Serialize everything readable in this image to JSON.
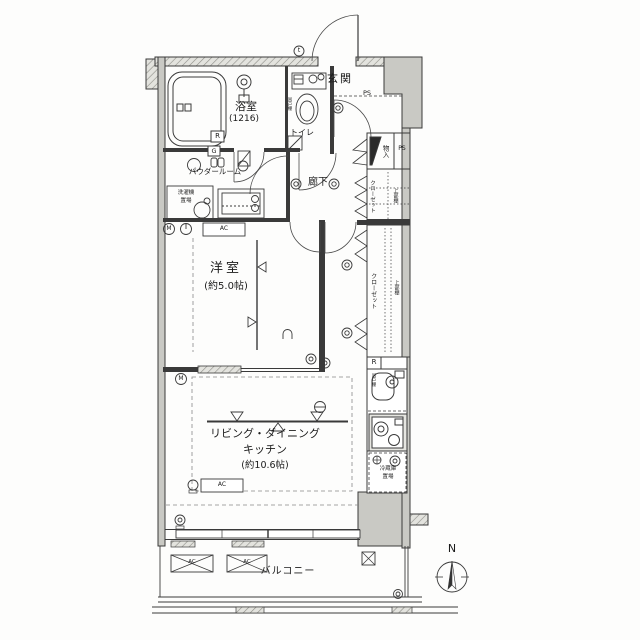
{
  "labels": {
    "entrance": "玄関",
    "bathroom": "浴室",
    "bathroom_size": "(1216)",
    "toilet": "トイレ",
    "hanging_shelf": "吊戸棚",
    "storage": "物入",
    "hallway": "廊下",
    "powder_room": "パウダールーム",
    "washer_line1": "洗濯機",
    "washer_line2": "置場",
    "closet": "クローゼット",
    "upper_shelf": "上部棚",
    "western_room": "洋室",
    "western_room_size": "(約5.0帖)",
    "ldk_line1": "リビング・ダイニング",
    "ldk_line2": "キッチン",
    "ldk_size": "(約10.6帖)",
    "fridge_line1": "冷蔵庫",
    "fridge_line2": "置場",
    "balcony": "バルコニー"
  },
  "marks": {
    "ps": "PS",
    "meter": "M",
    "gas": "G",
    "r_unit": "R",
    "ac": "AC",
    "tick": "t",
    "north": "N"
  },
  "colors": {
    "line": "#3a3a3a",
    "wall_fill": "#c9c9c4",
    "hatch": "#9a9a94",
    "dash": "#777777"
  }
}
